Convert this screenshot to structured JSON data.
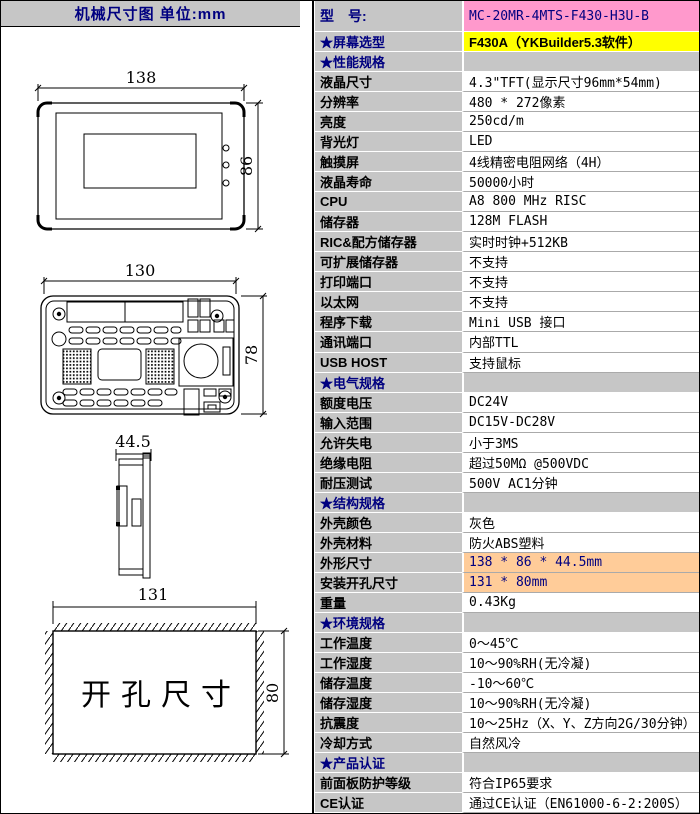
{
  "left_panel": {
    "header": "机械尺寸图  单位:mm",
    "drawings": {
      "front": {
        "width_label": "138",
        "height_label": "86"
      },
      "back": {
        "width_label": "130",
        "height_label": "78"
      },
      "side": {
        "depth_label": "44.5"
      },
      "cutout": {
        "width_label": "131",
        "height_label": "80",
        "label": "开孔尺寸"
      }
    }
  },
  "table": {
    "rows": [
      {
        "type": "model",
        "label": "型　号:",
        "value": "MC-20MR-4MTS-F430-H3U-B"
      },
      {
        "type": "screen",
        "label": "★屏幕选型",
        "value": "F430A（YKBuilder5.3软件）"
      },
      {
        "type": "section",
        "label": "★性能规格",
        "value": ""
      },
      {
        "type": "normal",
        "label": "液晶尺寸",
        "value": "4.3\"TFT(显示尺寸96mm*54mm)"
      },
      {
        "type": "normal",
        "label": "分辨率",
        "value": "480 * 272像素"
      },
      {
        "type": "normal",
        "label": "亮度",
        "value": "250cd/m"
      },
      {
        "type": "normal",
        "label": "背光灯",
        "value": "LED"
      },
      {
        "type": "normal",
        "label": "触摸屏",
        "value": "4线精密电阻网络（4H）"
      },
      {
        "type": "normal",
        "label": "液晶寿命",
        "value": "50000小时"
      },
      {
        "type": "normal",
        "label": "CPU",
        "value": "A8 800 MHz RISC"
      },
      {
        "type": "normal",
        "label": "储存器",
        "value": "128M FLASH"
      },
      {
        "type": "normal",
        "label": "RIC&配方储存器",
        "value": "实时时钟+512KB"
      },
      {
        "type": "normal",
        "label": "可扩展储存器",
        "value": "不支持"
      },
      {
        "type": "normal",
        "label": "打印端口",
        "value": "不支持"
      },
      {
        "type": "normal",
        "label": "以太网",
        "value": "不支持"
      },
      {
        "type": "normal",
        "label": "程序下载",
        "value": "Mini USB 接口"
      },
      {
        "type": "normal",
        "label": "通讯端口",
        "value": "内部TTL"
      },
      {
        "type": "normal",
        "label": "USB HOST",
        "value": "支持鼠标"
      },
      {
        "type": "section",
        "label": "★电气规格",
        "value": ""
      },
      {
        "type": "normal",
        "label": "额度电压",
        "value": "DC24V"
      },
      {
        "type": "normal",
        "label": "输入范围",
        "value": "DC15V-DC28V"
      },
      {
        "type": "normal",
        "label": "允许失电",
        "value": "小于3MS"
      },
      {
        "type": "normal",
        "label": "绝缘电阻",
        "value": "超过50MΩ @500VDC"
      },
      {
        "type": "normal",
        "label": "耐压测试",
        "value": "500V AC1分钟"
      },
      {
        "type": "section",
        "label": "★结构规格",
        "value": ""
      },
      {
        "type": "normal",
        "label": "外壳颜色",
        "value": "灰色"
      },
      {
        "type": "normal",
        "label": "外壳材料",
        "value": "防火ABS塑料"
      },
      {
        "type": "highlight",
        "label": "外形尺寸",
        "value": "138 * 86 * 44.5mm"
      },
      {
        "type": "highlight",
        "label": "安装开孔尺寸",
        "value": "131 * 80mm"
      },
      {
        "type": "normal",
        "label": "重量",
        "value": "0.43Kg"
      },
      {
        "type": "section",
        "label": "★环境规格",
        "value": ""
      },
      {
        "type": "normal",
        "label": "工作温度",
        "value": "0～45℃"
      },
      {
        "type": "normal",
        "label": "工作湿度",
        "value": "10～90%RH(无冷凝)"
      },
      {
        "type": "normal",
        "label": "储存温度",
        "value": "-10～60℃"
      },
      {
        "type": "normal",
        "label": "储存湿度",
        "value": "10～90%RH(无冷凝)"
      },
      {
        "type": "normal",
        "label": "抗震度",
        "value": "10～25Hz（X、Y、Z方向2G/30分钟）"
      },
      {
        "type": "normal",
        "label": "冷却方式",
        "value": "自然风冷"
      },
      {
        "type": "section",
        "label": "★产品认证",
        "value": ""
      },
      {
        "type": "normal",
        "label": "前面板防护等级",
        "value": "符合IP65要求"
      },
      {
        "type": "normal",
        "label": "CE认证",
        "value": "通过CE认证（EN61000-6-2:200S）"
      }
    ]
  },
  "colors": {
    "label_gray": "#c6c6c6",
    "navy": "#000080",
    "model_pink": "#ff99cc",
    "screen_yellow": "#ffff00",
    "dimension_orange": "#ffcc99"
  }
}
